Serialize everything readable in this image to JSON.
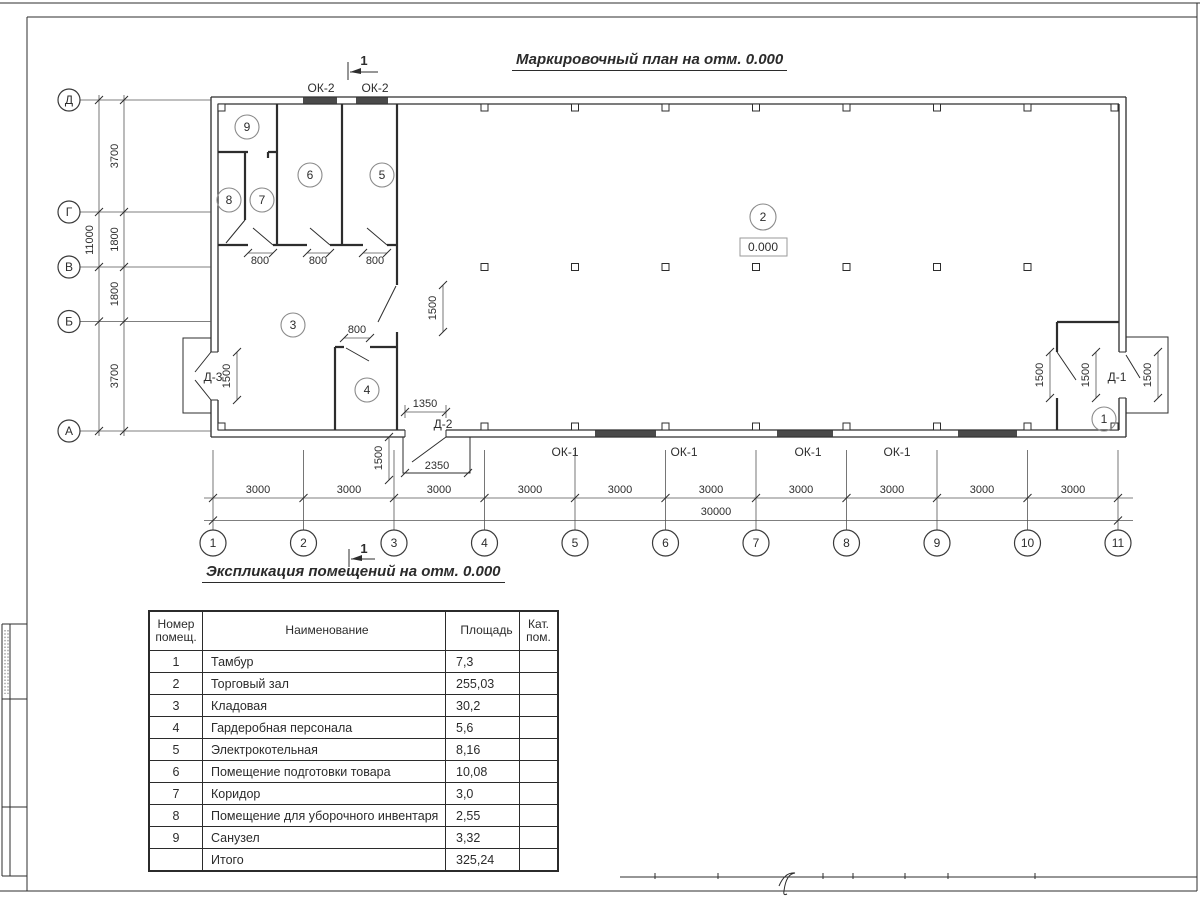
{
  "titles": {
    "plan": "Маркировочный план на отм. 0.000",
    "schedule": "Экспликация помещений на отм. 0.000"
  },
  "plan": {
    "row_axes": [
      "Д",
      "Г",
      "В",
      "Б",
      "А"
    ],
    "col_axes": [
      "1",
      "2",
      "3",
      "4",
      "5",
      "6",
      "7",
      "8",
      "9",
      "10",
      "11"
    ],
    "row_dims": [
      "3700",
      "1800",
      "1800",
      "3700"
    ],
    "row_total": "11000",
    "col_dim": "3000",
    "col_total": "30000",
    "rooms": [
      "1",
      "2",
      "3",
      "4",
      "5",
      "6",
      "7",
      "8",
      "9"
    ],
    "elevation": "0.000",
    "labels": {
      "ok1": "ОК-1",
      "ok2": "ОК-2",
      "d1": "Д-1",
      "d2": "Д-2",
      "d3": "Д-3"
    },
    "dims": {
      "w800": "800",
      "w1350": "1350",
      "w1500": "1500",
      "w2350": "2350"
    },
    "section": "1"
  },
  "schedule": {
    "headers": {
      "num": "Номер помещ.",
      "name": "Наименование",
      "area": "Площадь",
      "cat": "Кат. пом."
    },
    "rows": [
      {
        "num": "1",
        "name": "Тамбур",
        "area": "7,3",
        "cat": ""
      },
      {
        "num": "2",
        "name": "Торговый зал",
        "area": "255,03",
        "cat": ""
      },
      {
        "num": "3",
        "name": "Кладовая",
        "area": "30,2",
        "cat": ""
      },
      {
        "num": "4",
        "name": "Гардеробная персонала",
        "area": "5,6",
        "cat": ""
      },
      {
        "num": "5",
        "name": "Электрокотельная",
        "area": "8,16",
        "cat": ""
      },
      {
        "num": "6",
        "name": "Помещение подготовки товара",
        "area": "10,08",
        "cat": ""
      },
      {
        "num": "7",
        "name": "Коридор",
        "area": "3,0",
        "cat": ""
      },
      {
        "num": "8",
        "name": "Помещение для уборочного инвентаря",
        "area": "2,55",
        "cat": ""
      },
      {
        "num": "9",
        "name": "Санузел",
        "area": "3,32",
        "cat": ""
      },
      {
        "num": "",
        "name": "Итого",
        "area": "325,24",
        "cat": ""
      }
    ]
  }
}
